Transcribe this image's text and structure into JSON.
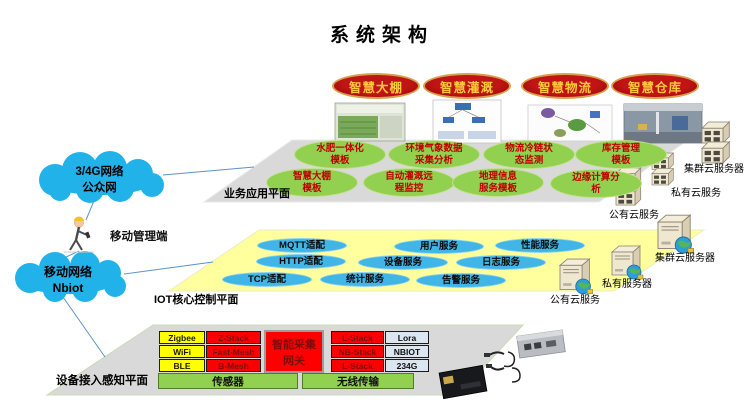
{
  "title": "系统架构",
  "apps": [
    "智慧大棚",
    "智慧灌溉",
    "智慧物流",
    "智慧仓库"
  ],
  "business_layer": {
    "label": "业务应用平面",
    "modules": [
      "水肥一体化\n模板",
      "环境气象数据\n采集分析",
      "物流冷链状\n态监测",
      "库存管理\n模板",
      "智慧大棚\n模板",
      "自动灌溉远\n程监控",
      "地理信息\n服务模板",
      "边缘计算分\n析"
    ]
  },
  "iot_layer": {
    "label": "IOT核心控制平面",
    "services": [
      "MQTT适配",
      "用户服务",
      "性能服务",
      "HTTP适配",
      "设备服务",
      "日志服务",
      "TCP适配",
      "统计服务",
      "告警服务"
    ]
  },
  "device_layer": {
    "label": "设备接入感知平面",
    "gateway": "智能采集\n网关",
    "left_table": [
      [
        "Zigbee",
        "Z-Stack"
      ],
      [
        "WiFi",
        "Fast-Mesh"
      ],
      [
        "BLE",
        "B-Mesh"
      ]
    ],
    "right_table": [
      [
        "L-Stack",
        "Lora"
      ],
      [
        "NB-Stack",
        "NBIOT"
      ],
      [
        "L-Stack",
        "234G"
      ]
    ],
    "bars": [
      "传感器",
      "无线传输"
    ]
  },
  "network": {
    "cloud1": "3/4G网络\n公众网",
    "cloud2": "移动网络\nNbiot",
    "mobile_admin": "移动管理端"
  },
  "servers": {
    "business": [
      "集群云服务器",
      "私有云服务",
      "公有云服务"
    ],
    "iot": [
      "集群云服务器",
      "私有服务器",
      "公有云服务"
    ]
  },
  "colors": {
    "app_fill": "#b11212",
    "app_text": "#ffc83d",
    "module_fill": "#92d050",
    "module_text": "#c00000",
    "service_fill": "#41b6e6",
    "plane_gray": "#d9d9d9",
    "plane_yellow": "#ffff9d",
    "cloud": "#22b2ea",
    "cell_yellow": "#ffff00",
    "cell_red": "#ff0000",
    "cell_blue": "#dce6f1",
    "bar_green": "#92d050"
  }
}
